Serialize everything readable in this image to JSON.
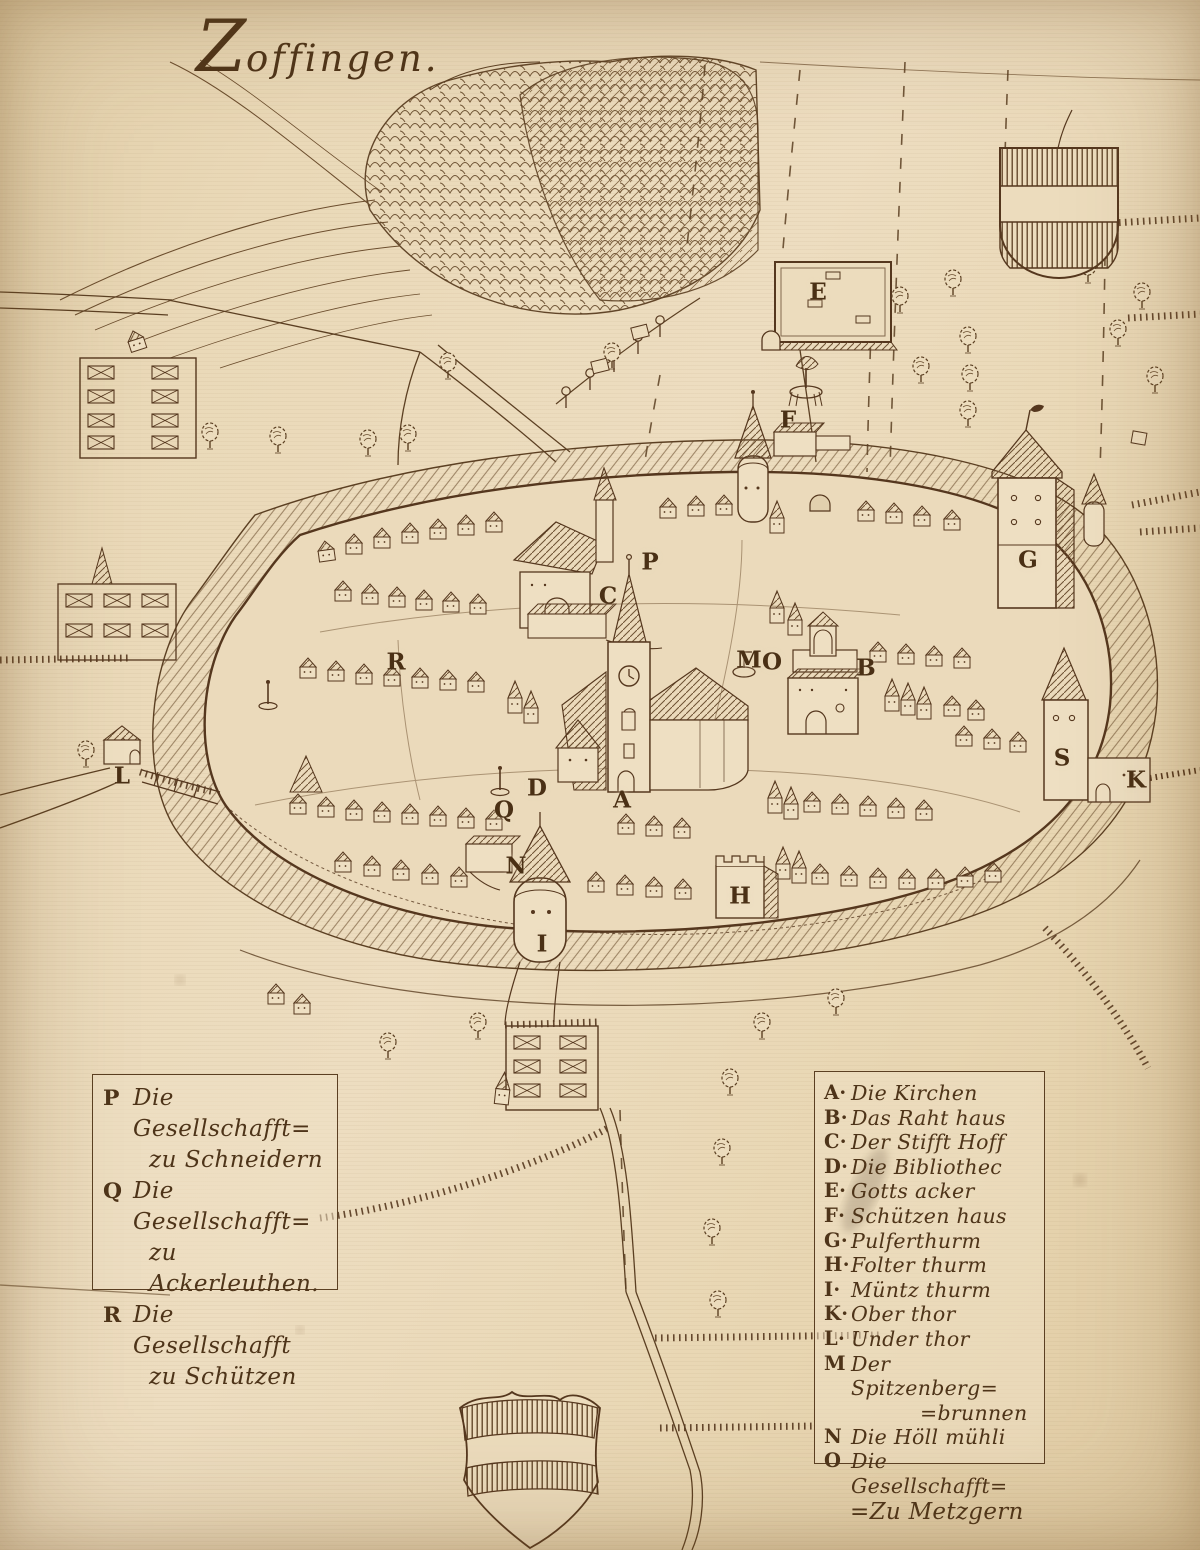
{
  "title": "Zoffingen.",
  "colors": {
    "paper": "#e9d8b8",
    "ink": "#55371e"
  },
  "legend_left": {
    "items": [
      {
        "letter": "P",
        "line1": "Die Gesellschafft=",
        "line2": "zu Schneidern"
      },
      {
        "letter": "Q",
        "line1": "Die Gesellschafft=",
        "line2": "zu Ackerleuthen."
      },
      {
        "letter": "R",
        "line1": "Die Gesellschafft",
        "line2": "zu Schützen"
      }
    ]
  },
  "legend_right": {
    "items": [
      {
        "letter": "A·",
        "text": "Die Kirchen"
      },
      {
        "letter": "B·",
        "text": "Das Raht haus"
      },
      {
        "letter": "C·",
        "text": "Der Stifft Hoff"
      },
      {
        "letter": "D·",
        "text": "Die Bibliothec"
      },
      {
        "letter": "E·",
        "text": "Gotts acker"
      },
      {
        "letter": "F·",
        "text": "Schützen haus"
      },
      {
        "letter": "G·",
        "text": "Pulferthurm"
      },
      {
        "letter": "H·",
        "text": "Folter thurm"
      },
      {
        "letter": "I·",
        "text": "Müntz thurm"
      },
      {
        "letter": "K·",
        "text": "Ober thor"
      },
      {
        "letter": "L·",
        "text": "Under thor"
      },
      {
        "letter": "M",
        "text": "Der Spitzenberg=",
        "text2": "=brunnen"
      },
      {
        "letter": "N",
        "text": "Die Höll mühli"
      },
      {
        "letter": "O",
        "text": "Die Gesellschafft=",
        "text2": "=Zu Metzgern"
      }
    ]
  },
  "markers": {
    "A": "A",
    "B": "B",
    "C": "C",
    "D": "D",
    "E": "E",
    "F": "F",
    "G": "G",
    "H": "H",
    "I": "I",
    "K": "K",
    "L": "L",
    "M": "M",
    "N": "N",
    "O": "O",
    "P": "P",
    "Q": "Q",
    "R": "R",
    "S": "S"
  }
}
